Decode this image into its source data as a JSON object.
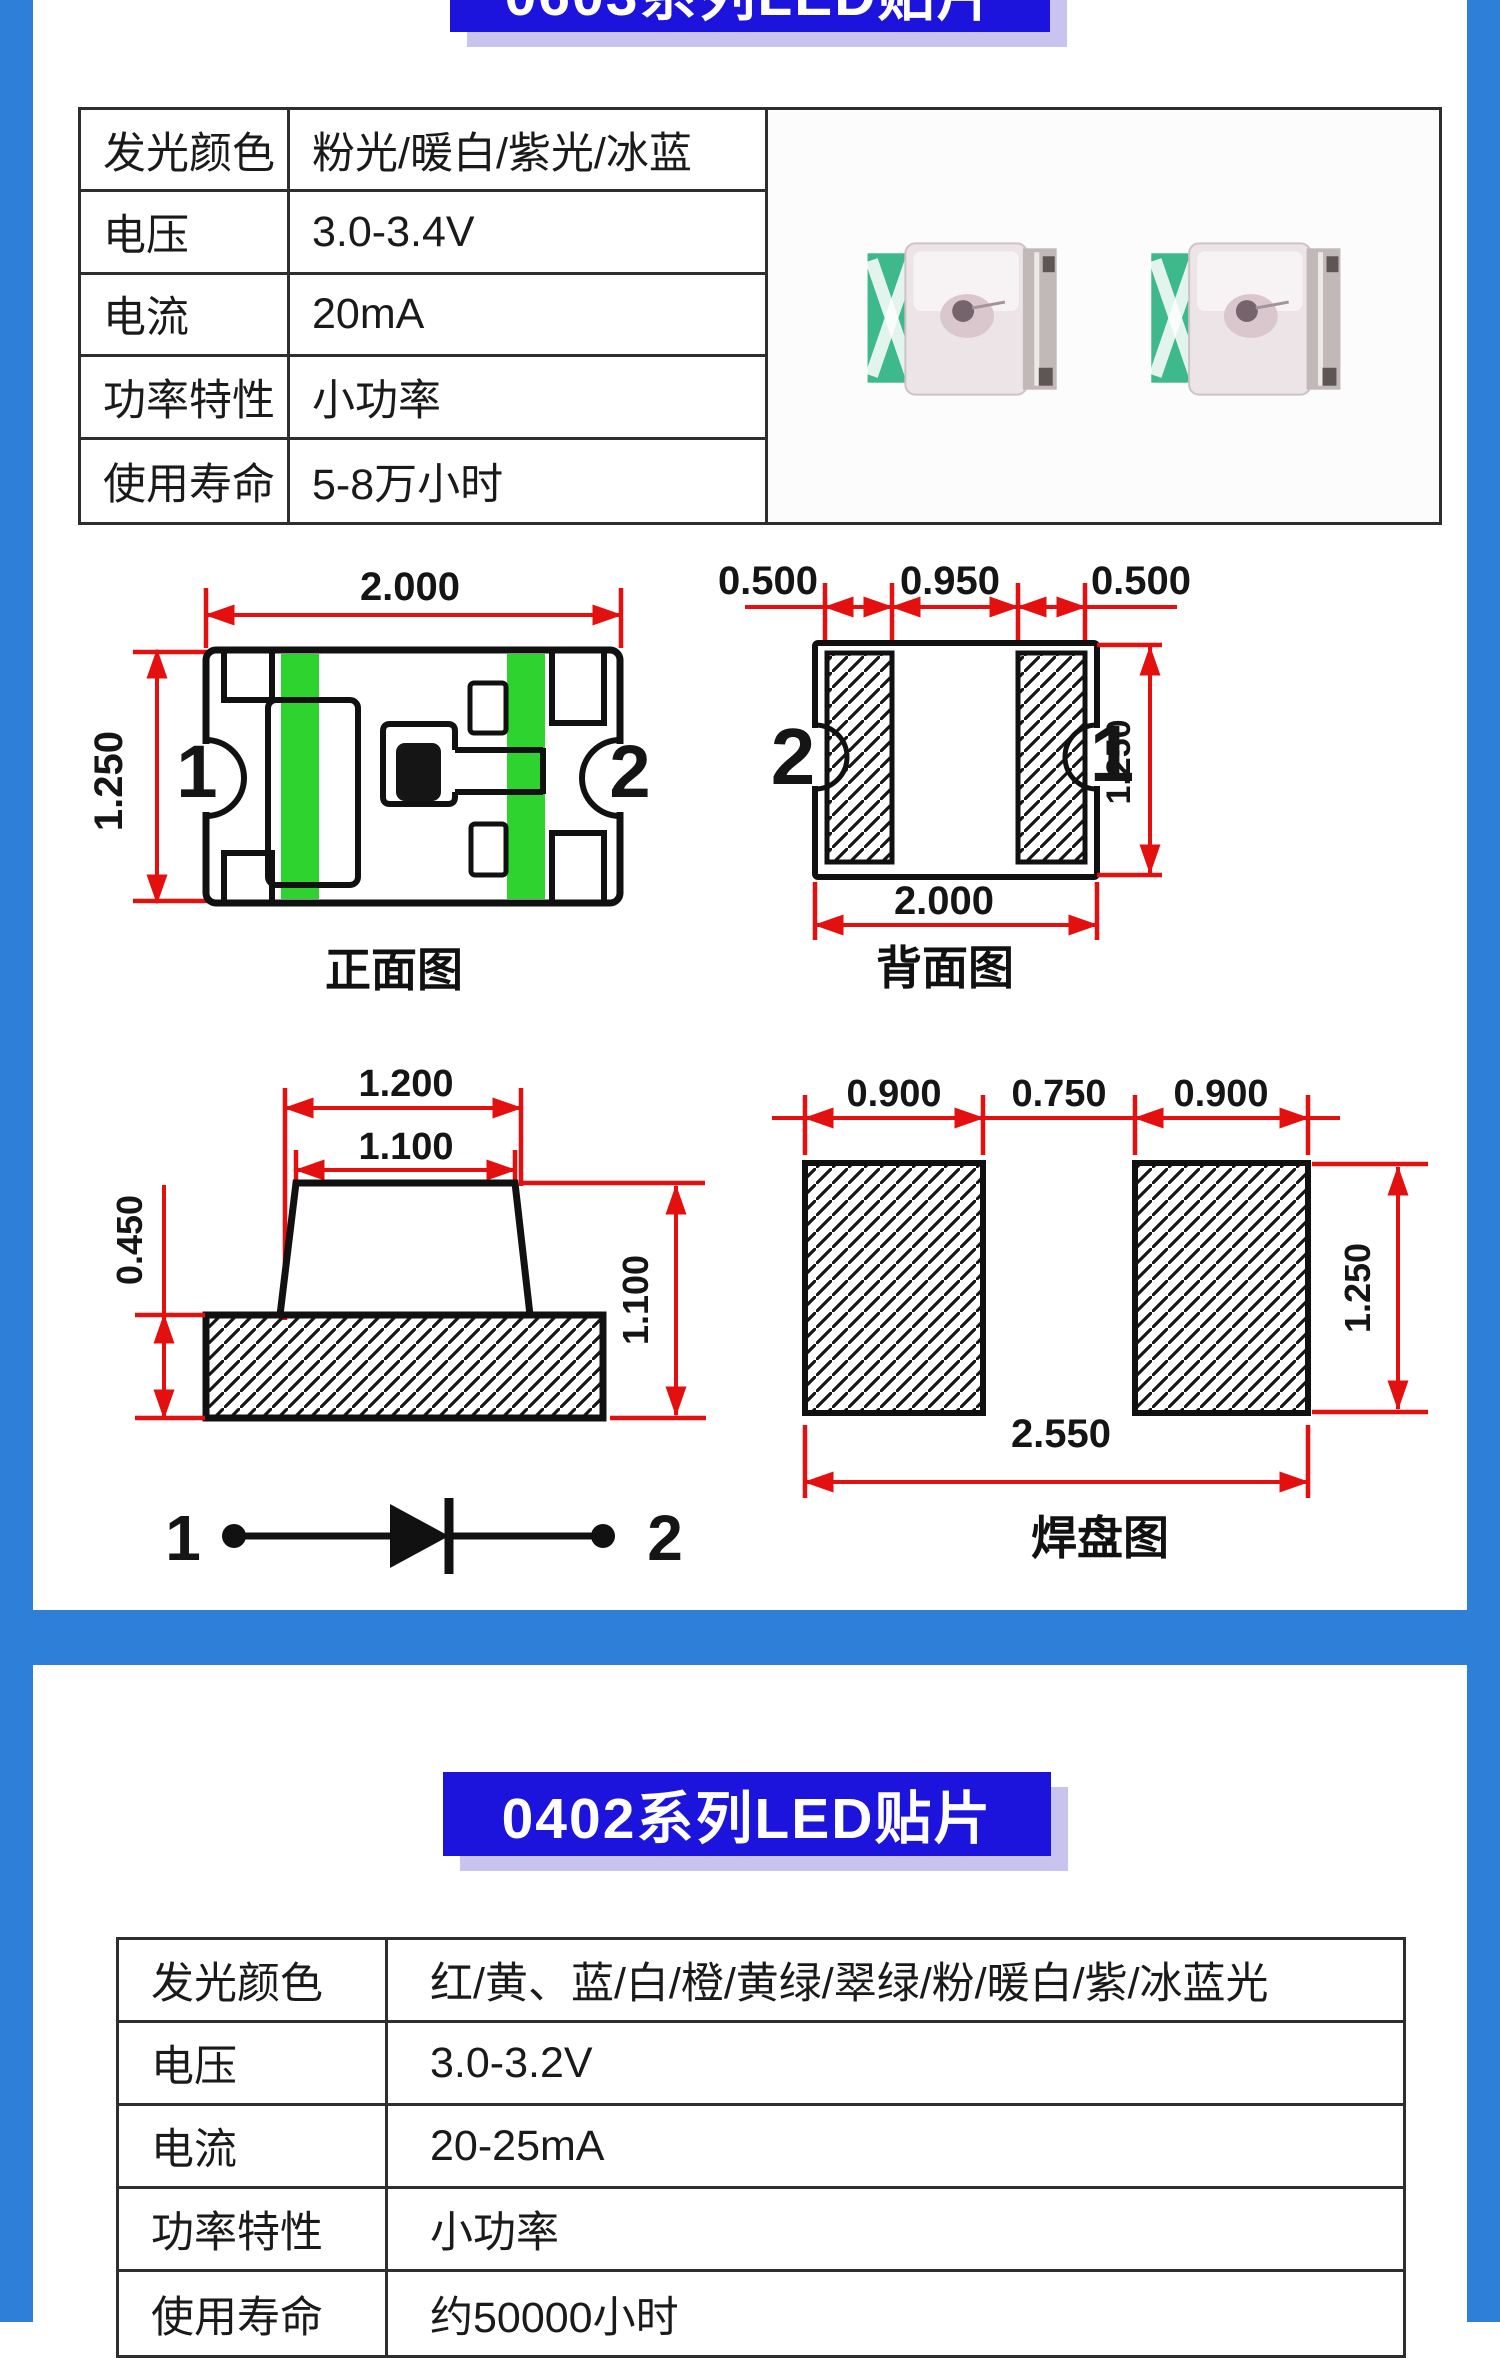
{
  "colors": {
    "accent_blue": "#2e7fd8",
    "banner_blue": "#1c13dd",
    "banner_shadow": "#c9c4ef",
    "dim_red": "#e40f0f",
    "pcb_green": "#2fd32f",
    "led_mint": "#3eb98c",
    "table_border": "#2e2e2e",
    "text_dark": "#1a1a1a"
  },
  "section1": {
    "title": "0603系列LED贴片",
    "spec_table": {
      "rows": [
        {
          "label": "发光颜色",
          "value": "粉光/暖白/紫光/冰蓝"
        },
        {
          "label": "电压",
          "value": "3.0-3.4V"
        },
        {
          "label": "电流",
          "value": "20mA"
        },
        {
          "label": "功率特性",
          "value": "小功率"
        },
        {
          "label": "使用寿命",
          "value": "5-8万小时"
        }
      ]
    },
    "front_view": {
      "label": "正面图",
      "width_dim": "2.000",
      "height_dim": "1.250",
      "pin1": "1",
      "pin2": "2"
    },
    "back_view": {
      "label": "背面图",
      "pad_dim_left": "0.500",
      "gap_dim": "0.950",
      "pad_dim_right": "0.500",
      "width_dim": "2.000",
      "height_dim": "1.250",
      "pin1": "1",
      "pin2": "2"
    },
    "side_view": {
      "outer_width_dim": "1.200",
      "lens_width_dim": "1.100",
      "base_height_dim": "0.450",
      "total_height_dim": "1.100",
      "pin1": "1",
      "pin2": "2"
    },
    "pad_view": {
      "label": "焊盘图",
      "pad_dim_left": "0.900",
      "gap_dim": "0.750",
      "pad_dim_right": "0.900",
      "height_dim": "1.250",
      "total_width_dim": "2.550"
    }
  },
  "section2": {
    "title": "0402系列LED贴片",
    "spec_table": {
      "rows": [
        {
          "label": "发光颜色",
          "value": "红/黄、蓝/白/橙/黄绿/翠绿/粉/暖白/紫/冰蓝光"
        },
        {
          "label": "电压",
          "value": "3.0-3.2V"
        },
        {
          "label": "电流",
          "value": "20-25mA"
        },
        {
          "label": "功率特性",
          "value": "小功率"
        },
        {
          "label": "使用寿命",
          "value": "约50000小时"
        }
      ]
    }
  }
}
